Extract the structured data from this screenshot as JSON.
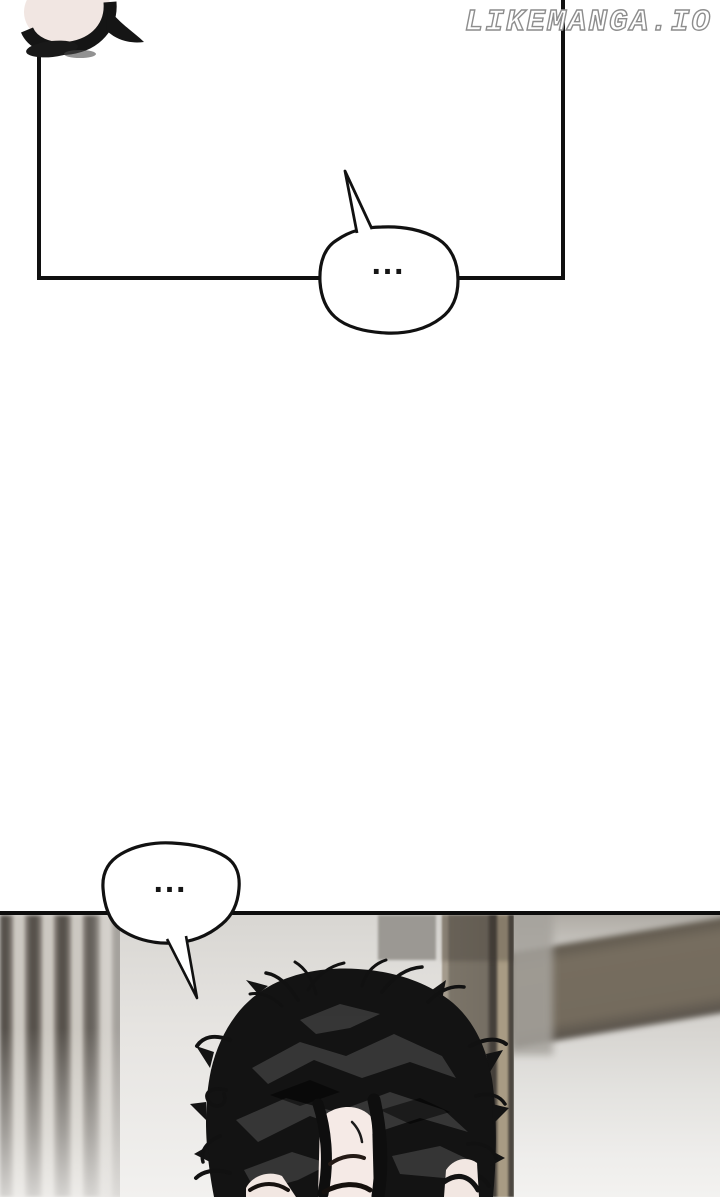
{
  "page": {
    "width_px": 720,
    "height_px": 1197,
    "background_color": "#ffffff",
    "kind": "manga-reader-page"
  },
  "watermark": {
    "text": "LIKEMANGA.IO",
    "text_color": "#ffffff",
    "outline_color": "#8d8d8d"
  },
  "panels": [
    {
      "id": "panel-top",
      "position": "top",
      "border_color": "#101010",
      "background": "#ffffff"
    },
    {
      "id": "panel-bottom",
      "position": "bottom",
      "border_color": "#0d0d0d"
    }
  ],
  "speech_bubbles": [
    {
      "id": "bubble-1",
      "text": "...",
      "tail_direction": "up-left",
      "fill": "#ffffff",
      "stroke": "#111111"
    },
    {
      "id": "bubble-2",
      "text": "...",
      "tail_direction": "down-right",
      "fill": "#ffffff",
      "stroke": "#111111"
    }
  ],
  "artwork_palette": {
    "ink_black": "#131313",
    "hair_highlight_gray": "#3a3a3a",
    "skin": "#f5eae6",
    "pale_object": "#f1e6e2",
    "wall_light": "#e2e0dd",
    "stripe_dark": "#57524c",
    "stripe_light": "#ccc8c1",
    "pillar_brown": "#756e63",
    "beam_tan": "#a89b84",
    "door_band_brown": "#746b5d",
    "door_gray": "#d8d6d2"
  }
}
